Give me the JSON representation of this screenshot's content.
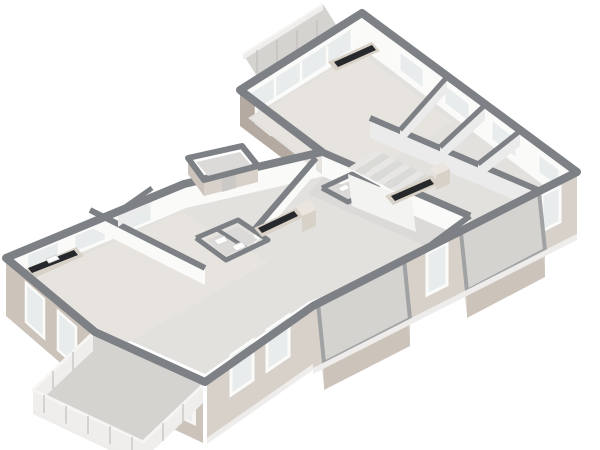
{
  "palette": {
    "wallTop": "#7d8084",
    "capLight": "#a0a2a4",
    "extLight": "#d8d1c9",
    "extMid": "#ccc4bb",
    "extDark": "#b4aaa1",
    "intWhite": "#fafaf9",
    "intShade": "#ebebec",
    "floorMain": "#e3e1de",
    "floorWarm": "#e7e4e0",
    "floorCool": "#dbdad8",
    "balconyFloor": "#d4d3d0",
    "glass": "#e9eced",
    "frame": "#fbfbfa",
    "counter": "#26282b",
    "cabinet": "#d8d1c7",
    "cabinetLight": "#eae5de",
    "stepA": "#e7e6e4",
    "stepB": "#dadad7",
    "railPanel": "#efeeec",
    "railTop": "#f6f5f3",
    "railPost": "#c2bfbb",
    "fixWhite": "#fdfdfd",
    "fixEdge": "#d6d6d4",
    "doorDark": "#cbc9c6",
    "stringer": "#f3f3f1",
    "shadow": "#eeedeb",
    "background": "#ffffff"
  },
  "canvas": {
    "width": 600,
    "height": 450
  },
  "elements": [
    {
      "t": "p",
      "name": "top-balcony-floor",
      "k": "balconyFloor",
      "pts": "258,78 338,28 323,4 243,54"
    },
    {
      "t": "p",
      "name": "top-balcony-rail-face",
      "k": "railPanel",
      "pts": "243,54 323,4 323,10 243,60"
    },
    {
      "t": "l",
      "name": "top-balcony-rail-top",
      "k": "railTop",
      "w": 2,
      "pts": "243,54 323,4"
    },
    {
      "t": "l",
      "name": "top-balcony-rail-post",
      "k": "railPost",
      "w": 1.2,
      "pts": "257,50 257,73"
    },
    {
      "t": "l",
      "name": "top-balcony-rail-post",
      "k": "railPost",
      "w": 1.2,
      "pts": "277,40 277,63"
    },
    {
      "t": "l",
      "name": "top-balcony-rail-post",
      "k": "railPost",
      "w": 1.2,
      "pts": "297,30 297,53"
    },
    {
      "t": "l",
      "name": "top-balcony-rail-post",
      "k": "railPost",
      "w": 1.2,
      "pts": "317,20 317,43"
    },
    {
      "t": "p",
      "name": "ne-wall-face",
      "k": "intWhite",
      "pts": "362,13 577,172 577,209 362,50"
    },
    {
      "t": "p",
      "name": "ne-window",
      "k": "glass",
      "s": "frame",
      "w": 3,
      "pts": "399,50 424,69 424,90 399,71"
    },
    {
      "t": "p",
      "name": "ne-window",
      "k": "glass",
      "s": "frame",
      "w": 3,
      "pts": "444,83 470,103 470,124 444,104"
    },
    {
      "t": "p",
      "name": "ne-window",
      "k": "glass",
      "s": "frame",
      "w": 3,
      "pts": "491,118 517,138 517,160 491,140"
    },
    {
      "t": "p",
      "name": "ne-window",
      "k": "glass",
      "s": "frame",
      "w": 3,
      "pts": "538,153 560,169 560,189 538,173"
    },
    {
      "t": "p",
      "name": "nw-topwing-face",
      "k": "intWhite",
      "pts": "240,90 362,13 362,50 240,127"
    },
    {
      "t": "p",
      "name": "nw-glazing",
      "k": "glass",
      "s": "frame",
      "w": 3,
      "pts": "250,92 352,27 352,50 250,115"
    },
    {
      "t": "l",
      "name": "nw-glazing-mullion",
      "k": "frame",
      "w": 2.5,
      "pts": "275,78 275,101"
    },
    {
      "t": "l",
      "name": "nw-glazing-mullion",
      "k": "frame",
      "w": 2.5,
      "pts": "301,62 301,85"
    },
    {
      "t": "l",
      "name": "nw-glazing-mullion",
      "k": "frame",
      "w": 2.5,
      "pts": "327,46 327,69"
    },
    {
      "t": "p",
      "name": "swend-wall-face",
      "k": "extDark",
      "pts": "240,90 322,152 322,188 240,126"
    },
    {
      "t": "p",
      "name": "swend-window",
      "k": "glass",
      "s": "frame",
      "w": 2.5,
      "pts": "256,106 270,117 270,134 256,123"
    },
    {
      "t": "p",
      "name": "swend-window",
      "k": "glass",
      "s": "frame",
      "w": 2.5,
      "pts": "288,130 302,141 302,158 288,147"
    },
    {
      "t": "p",
      "name": "mainnw-wall-face",
      "k": "intWhite",
      "pts": "184,184 322,152 322,178 184,210"
    },
    {
      "t": "p",
      "name": "leftnw-wall-face",
      "k": "intWhite",
      "pts": "6,258 184,184 184,212 6,286"
    },
    {
      "t": "p",
      "name": "leftnw-window",
      "k": "glass",
      "s": "frame",
      "w": 2.5,
      "pts": "27,254 59,241 59,259 27,272"
    },
    {
      "t": "p",
      "name": "leftnw-window",
      "k": "glass",
      "s": "frame",
      "w": 2.5,
      "pts": "74,235 106,222 106,240 74,253"
    },
    {
      "t": "p",
      "name": "leftnw-window",
      "k": "glass",
      "s": "frame",
      "w": 2.5,
      "pts": "120,216 152,203 152,221 120,234"
    },
    {
      "t": "p",
      "name": "floor-slab",
      "k": "floorMain",
      "pts": "362,48 570,205 308,302 205,374 97,326 16,280 186,208 324,176 248,118"
    },
    {
      "t": "p",
      "name": "floor-topwing",
      "k": "floorWarm",
      "pts": "252,118 360,52 452,122 344,188"
    },
    {
      "t": "p",
      "name": "floor-corridor",
      "k": "floorCool",
      "pts": "324,176 470,238 448,256 308,194"
    },
    {
      "t": "p",
      "name": "floor-living-left",
      "k": "floorWarm",
      "pts": "26,282 180,212 268,262 118,348"
    },
    {
      "t": "p",
      "name": "partition-face",
      "k": "intWhite",
      "pts": "322,152 470,216 470,240 322,176"
    },
    {
      "t": "l",
      "name": "partition-cap",
      "k": "wallTop",
      "w": 7,
      "pts": "322,152 470,216"
    },
    {
      "t": "p",
      "name": "partition-face",
      "k": "intShade",
      "pts": "370,118 545,193 545,213 370,138"
    },
    {
      "t": "l",
      "name": "partition-cap",
      "k": "wallTop",
      "w": 6,
      "pts": "370,118 545,193"
    },
    {
      "t": "p",
      "name": "partition-face",
      "k": "intWhite",
      "pts": "470,216 432,244 432,260 470,232"
    },
    {
      "t": "l",
      "name": "partition-cap",
      "k": "wallTop",
      "w": 6,
      "pts": "470,216 432,244"
    },
    {
      "t": "p",
      "name": "partition-face",
      "k": "intShade",
      "pts": "447,77 400,130 400,145 447,92"
    },
    {
      "t": "l",
      "name": "partition-cap",
      "k": "wallTop",
      "w": 5,
      "pts": "447,77 400,130"
    },
    {
      "t": "p",
      "name": "partition-face",
      "k": "intShade",
      "pts": "485,105 440,147 440,162 485,120"
    },
    {
      "t": "l",
      "name": "partition-cap",
      "k": "wallTop",
      "w": 5,
      "pts": "485,105 440,147"
    },
    {
      "t": "p",
      "name": "partition-face",
      "k": "intShade",
      "pts": "520,131 478,164 478,179 520,146"
    },
    {
      "t": "l",
      "name": "partition-cap",
      "k": "wallTop",
      "w": 5,
      "pts": "520,131 478,164"
    },
    {
      "t": "p",
      "name": "partition-face",
      "k": "intWhite",
      "pts": "90,210 205,268 205,285 90,227"
    },
    {
      "t": "l",
      "name": "partition-cap",
      "k": "wallTop",
      "w": 6,
      "pts": "90,210 205,268"
    },
    {
      "t": "p",
      "name": "partition-face",
      "k": "intShade",
      "pts": "152,188 118,212 118,227 152,203"
    },
    {
      "t": "l",
      "name": "partition-cap",
      "k": "wallTop",
      "w": 5,
      "pts": "152,188 118,212"
    },
    {
      "t": "p",
      "name": "partition-face",
      "k": "intWhite",
      "pts": "316,158 254,230 254,245 316,173"
    },
    {
      "t": "l",
      "name": "partition-cap",
      "k": "wallTop",
      "w": 6,
      "pts": "316,158 254,230"
    },
    {
      "t": "p",
      "name": "bath-left-floor",
      "k": "floorCool",
      "pts": "206,240 238,226 258,240 226,256"
    },
    {
      "t": "l",
      "name": "bath-left-wall-cap",
      "k": "wallTop",
      "w": 5,
      "pts": "196,238 238,220 268,240 226,260 196,238"
    },
    {
      "t": "l",
      "name": "bath-left-divider-cap",
      "k": "wallTop",
      "w": 4,
      "pts": "218,230 246,248"
    },
    {
      "t": "p",
      "name": "toilet",
      "k": "fixWhite",
      "s": "fixEdge",
      "w": 1,
      "pts": "214,240 224,236 228,241 218,245"
    },
    {
      "t": "p",
      "name": "sink",
      "k": "fixWhite",
      "s": "fixEdge",
      "w": 1,
      "pts": "232,246 242,242 246,247 236,251"
    },
    {
      "t": "p",
      "name": "bath-right-floor",
      "k": "floorCool",
      "pts": "330,189 352,180 368,189 346,198"
    },
    {
      "t": "l",
      "name": "bath-right-wall-cap",
      "k": "wallTop",
      "w": 5,
      "pts": "322,188 352,174 378,188 348,202 322,188"
    },
    {
      "t": "p",
      "name": "toilet",
      "k": "fixWhite",
      "s": "fixEdge",
      "w": 1,
      "pts": "338,188 346,184 350,188 342,192"
    },
    {
      "t": "p",
      "name": "sink",
      "k": "fixWhite",
      "s": "fixEdge",
      "w": 1,
      "pts": "352,192 360,188 364,192 356,196"
    },
    {
      "t": "p",
      "name": "stair-stringer-wall",
      "k": "stringer",
      "pts": "348,174 412,200 416,232 352,206"
    },
    {
      "t": "p",
      "name": "stair-step",
      "k": "stepA",
      "pts": "376,150 383,153 355,171 348,168"
    },
    {
      "t": "p",
      "name": "stair-step",
      "k": "stepB",
      "pts": "383,153 390,157 362,175 355,171"
    },
    {
      "t": "p",
      "name": "stair-step",
      "k": "stepA",
      "pts": "390,157 397,160 369,178 362,175"
    },
    {
      "t": "p",
      "name": "stair-step",
      "k": "stepB",
      "pts": "397,160 404,164 376,182 369,178"
    },
    {
      "t": "p",
      "name": "stair-step",
      "k": "stepA",
      "pts": "404,164 411,167 383,185 376,182"
    },
    {
      "t": "p",
      "name": "stair-step",
      "k": "stepB",
      "pts": "411,167 418,171 390,189 383,185"
    },
    {
      "t": "p",
      "name": "stair-step",
      "k": "stepA",
      "pts": "418,171 425,174 397,192 390,189"
    },
    {
      "t": "p",
      "name": "stair-step",
      "k": "stepB",
      "pts": "425,174 432,178 404,196 397,192"
    },
    {
      "t": "p",
      "name": "kitchen-cabinet",
      "k": "cabinet",
      "pts": "328,62 372,42 380,51 336,71"
    },
    {
      "t": "p",
      "name": "kitchen-counter",
      "k": "counter",
      "pts": "334,62 372,45 376,50 338,67"
    },
    {
      "t": "p",
      "name": "kitchen-cabinet",
      "k": "cabinet",
      "pts": "385,196 432,175 440,184 393,205"
    },
    {
      "t": "p",
      "name": "kitchen-counter",
      "k": "counter",
      "pts": "391,196 430,179 434,184 395,201"
    },
    {
      "t": "p",
      "name": "kitchen-tall-cabinet",
      "k": "cabinetLight",
      "pts": "430,168 444,162 450,169 436,175"
    },
    {
      "t": "p",
      "name": "kitchen-tall-cabinet-face",
      "k": "cabinet",
      "pts": "436,175 450,169 450,184 436,190"
    },
    {
      "t": "p",
      "name": "kitchen-cabinet",
      "k": "cabinet",
      "pts": "254,228 296,208 304,217 262,237"
    },
    {
      "t": "p",
      "name": "kitchen-counter",
      "k": "counter",
      "pts": "258,228 294,211 298,216 262,233"
    },
    {
      "t": "p",
      "name": "kitchen-tall-cabinet",
      "k": "cabinetLight",
      "pts": "296,206 310,200 316,210 302,216"
    },
    {
      "t": "p",
      "name": "kitchen-tall-cabinet-face",
      "k": "cabinet",
      "pts": "302,216 316,210 316,226 302,232"
    },
    {
      "t": "p",
      "name": "kitchen-cabinet",
      "k": "cabinet",
      "pts": "24,270 76,247 84,256 32,279"
    },
    {
      "t": "p",
      "name": "kitchen-counter",
      "k": "counter",
      "pts": "28,268 74,250 78,255 32,273"
    },
    {
      "t": "p",
      "name": "kitchen-sink",
      "k": "fixWhite",
      "s": "fixEdge",
      "w": 1,
      "pts": "46,259 56,255 59,259 49,263"
    },
    {
      "t": "p",
      "name": "se-right-wall-face",
      "k": "extLight",
      "pts": "577,172 313,306 313,368 577,234"
    },
    {
      "t": "p",
      "name": "se-window",
      "k": "glass",
      "s": "frame",
      "w": 3,
      "pts": "560,186 542,195 542,231 560,222"
    },
    {
      "t": "p",
      "name": "se-balcony-door",
      "k": "glass",
      "s": "frame",
      "w": 3,
      "pts": "523,205 501,216 501,262 523,251"
    },
    {
      "t": "p",
      "name": "se-window",
      "k": "glass",
      "s": "frame",
      "w": 3,
      "pts": "447,243 427,253 427,295 447,285"
    },
    {
      "t": "p",
      "name": "se-balcony-door",
      "k": "glass",
      "s": "frame",
      "w": 3,
      "pts": "371,281 349,292 349,334 371,323"
    },
    {
      "t": "p",
      "name": "se-left-wall-face",
      "k": "extLight",
      "pts": "313,306 207,380 207,438 313,364"
    },
    {
      "t": "p",
      "name": "se-window",
      "k": "glass",
      "s": "frame",
      "w": 3,
      "pts": "289,315 267,330 267,371 289,356"
    },
    {
      "t": "p",
      "name": "se-window",
      "k": "glass",
      "s": "frame",
      "w": 3,
      "pts": "253,340 231,355 231,395 253,380"
    },
    {
      "t": "p",
      "name": "balcony-left-wall-face",
      "k": "extMid",
      "pts": "93,333 203,385 203,443 93,391"
    },
    {
      "t": "p",
      "name": "balcony-left-door-frame",
      "k": "railTop",
      "pts": "104,344 196,387 196,426 104,383"
    },
    {
      "t": "p",
      "name": "balcony-left-door-glass",
      "k": "glass",
      "pts": "108,348 192,388 192,421 108,381"
    },
    {
      "t": "l",
      "name": "balcony-door-mullion",
      "k": "frame",
      "w": 2.5,
      "pts": "130,359 130,392"
    },
    {
      "t": "l",
      "name": "balcony-door-mullion",
      "k": "frame",
      "w": 2.5,
      "pts": "152,369 152,402"
    },
    {
      "t": "l",
      "name": "balcony-door-mullion",
      "k": "frame",
      "w": 2.5,
      "pts": "174,379 174,412"
    },
    {
      "t": "p",
      "name": "sw-wall-face",
      "k": "extMid",
      "pts": "6,258 93,333 93,391 6,316"
    },
    {
      "t": "p",
      "name": "sw-window",
      "k": "glass",
      "s": "frame",
      "w": 2.5,
      "pts": "26,283 44,299 44,338 26,322"
    },
    {
      "t": "p",
      "name": "sw-window",
      "k": "glass",
      "s": "frame",
      "w": 2.5,
      "pts": "58,311 76,327 76,366 58,350"
    },
    {
      "t": "p",
      "name": "balcony-right-floor",
      "k": "balconyFloor",
      "pts": "461,233 539,192 545,250 467,291"
    },
    {
      "t": "p",
      "name": "balcony-right-rail-face",
      "k": "extMid",
      "pts": "467,291 545,250 545,277 467,318"
    },
    {
      "t": "p",
      "name": "balcony-right-side-face",
      "k": "extLight",
      "pts": "461,233 467,291 467,315 461,257"
    },
    {
      "t": "p",
      "name": "balcony-right-side-face",
      "k": "extLight",
      "pts": "539,192 545,250 545,274 539,216"
    },
    {
      "t": "l",
      "name": "balcony-rail-cap",
      "k": "capLight",
      "w": 4,
      "pts": "461,233 467,291 545,250 539,192"
    },
    {
      "t": "p",
      "name": "balcony-mid-floor",
      "k": "balconyFloor",
      "pts": "318,303 404,259 410,319 324,363"
    },
    {
      "t": "p",
      "name": "balcony-mid-rail-face",
      "k": "extMid",
      "pts": "324,363 410,319 410,346 324,390"
    },
    {
      "t": "p",
      "name": "balcony-mid-side-face",
      "k": "extLight",
      "pts": "318,303 324,363 324,387 318,327"
    },
    {
      "t": "p",
      "name": "balcony-mid-side-face",
      "k": "extLight",
      "pts": "404,259 410,319 410,343 404,283"
    },
    {
      "t": "l",
      "name": "balcony-rail-cap",
      "k": "capLight",
      "w": 4,
      "pts": "318,303 324,363 410,319 404,259"
    },
    {
      "t": "p",
      "name": "balcony-big-floor",
      "k": "balconyFloor",
      "pts": "93,333 203,385 143,442 33,390"
    },
    {
      "t": "p",
      "name": "balcony-big-rail-face",
      "k": "railPanel",
      "pts": "33,390 143,442 143,460 33,408"
    },
    {
      "t": "p",
      "name": "balcony-big-side-face",
      "k": "railPanel",
      "pts": "93,333 33,390 33,408 93,351"
    },
    {
      "t": "p",
      "name": "balcony-big-side-face",
      "k": "railPanel",
      "pts": "203,385 143,442 143,460 203,403"
    },
    {
      "t": "l",
      "name": "balcony-rail-top",
      "k": "railTop",
      "w": 3,
      "pts": "93,333 33,390 143,442 203,385"
    },
    {
      "t": "l",
      "name": "balcony-rail-post",
      "k": "railPost",
      "w": 1.2,
      "pts": "44,395 44,413"
    },
    {
      "t": "l",
      "name": "balcony-rail-post",
      "k": "railPost",
      "w": 1.2,
      "pts": "66,406 66,424"
    },
    {
      "t": "l",
      "name": "balcony-rail-post",
      "k": "railPost",
      "w": 1.2,
      "pts": "88,416 88,434"
    },
    {
      "t": "l",
      "name": "balcony-rail-post",
      "k": "railPost",
      "w": 1.2,
      "pts": "110,426 110,444"
    },
    {
      "t": "l",
      "name": "balcony-rail-post",
      "k": "railPost",
      "w": 1.2,
      "pts": "132,437 132,455"
    },
    {
      "t": "l",
      "name": "balcony-rail-post",
      "k": "railPost",
      "w": 1.2,
      "pts": "73,352 73,370"
    },
    {
      "t": "l",
      "name": "balcony-rail-post",
      "k": "railPost",
      "w": 1.2,
      "pts": "53,371 53,389"
    },
    {
      "t": "l",
      "name": "balcony-rail-post",
      "k": "railPost",
      "w": 1.2,
      "pts": "183,404 183,422"
    },
    {
      "t": "l",
      "name": "balcony-rail-post",
      "k": "railPost",
      "w": 1.2,
      "pts": "163,423 163,441"
    },
    {
      "t": "g",
      "name": "exterior-wall-cap",
      "k": "wallTop",
      "w": 8,
      "pts": "362,13 577,172 313,306 205,382 95,332 6,258 184,184 322,152 240,90"
    },
    {
      "t": "p",
      "name": "vestibule-floor",
      "k": "floorCool",
      "pts": "196,162 240,152 252,166 208,176"
    },
    {
      "t": "p",
      "name": "vestibule-sw-face",
      "k": "extMid",
      "pts": "188,158 204,180 204,196 188,174"
    },
    {
      "t": "p",
      "name": "vestibule-se-face",
      "k": "extLight",
      "pts": "204,180 258,166 258,182 204,196"
    },
    {
      "t": "p",
      "name": "vestibule-door",
      "k": "doorDark",
      "pts": "222,176 236,172 236,188 222,192"
    },
    {
      "t": "g",
      "name": "vestibule-wall-cap",
      "k": "wallTop",
      "w": 6,
      "pts": "188,158 242,146 258,166 204,180"
    },
    {
      "t": "p",
      "name": "drop-shadow",
      "k": "shadow",
      "pts": "313,368 577,234 577,240 313,374"
    },
    {
      "t": "p",
      "name": "drop-shadow",
      "k": "shadow",
      "pts": "207,438 313,364 313,370 207,444"
    },
    {
      "t": "p",
      "name": "drop-shadow",
      "k": "shadow",
      "pts": "33,408 143,460 143,466 33,414"
    }
  ]
}
